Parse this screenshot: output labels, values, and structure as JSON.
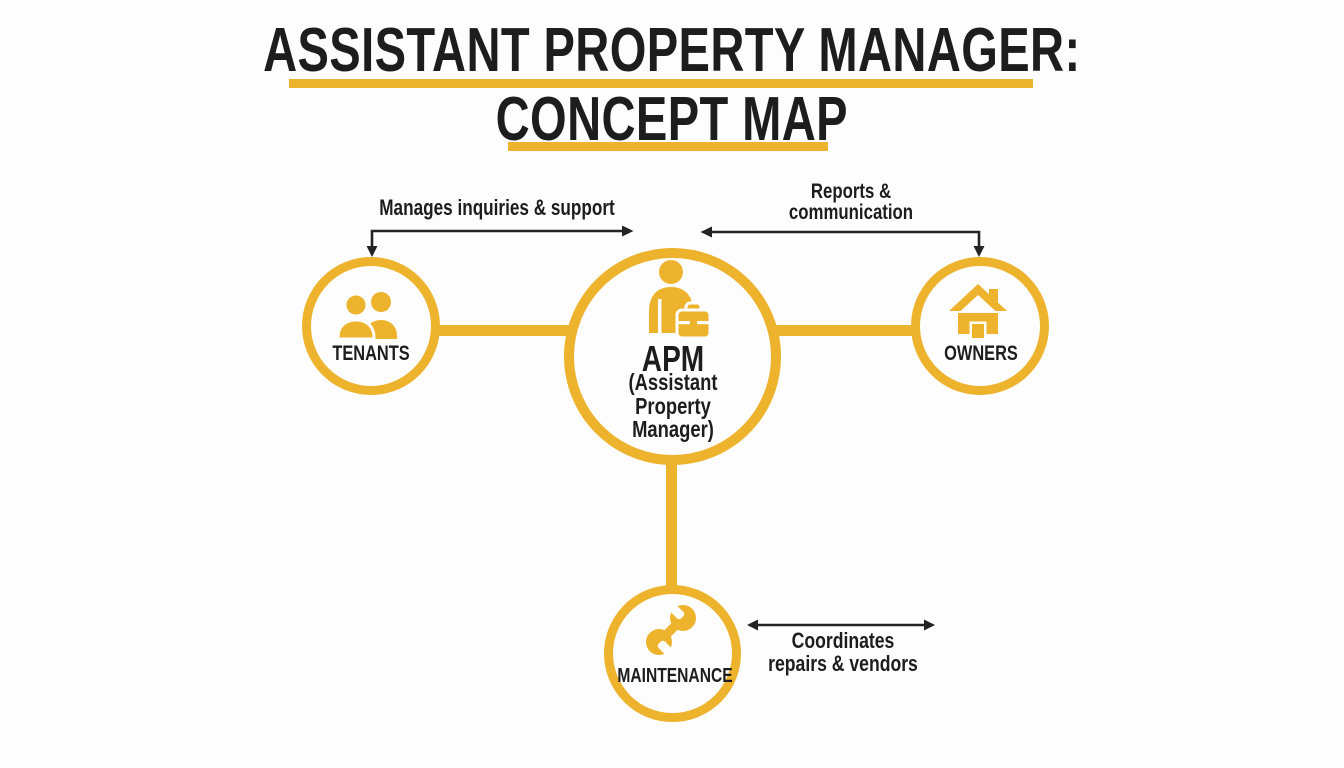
{
  "title": {
    "line1": "ASSISTANT PROPERTY MANAGER:",
    "line2": "CONCEPT MAP"
  },
  "center_node": {
    "label": "APM",
    "sublabel_lines": [
      "(Assistant",
      "Property",
      "Manager)"
    ],
    "icon": "person-briefcase-icon"
  },
  "nodes": [
    {
      "id": "tenants",
      "label": "TENANTS",
      "icon": "two-people-icon"
    },
    {
      "id": "owners",
      "label": "OWNERS",
      "icon": "house-icon"
    },
    {
      "id": "maintenance",
      "label": "MAINTENANCE",
      "icon": "wrench-icon"
    }
  ],
  "edge_labels": {
    "tenants": {
      "lines": [
        "Manages inquiries & support"
      ]
    },
    "owners": {
      "lines": [
        "Reports &",
        "communication"
      ]
    },
    "maintenance": {
      "lines": [
        "Coordinates",
        "repairs & vendors"
      ]
    }
  },
  "colors": {
    "accent_gold": "#EDB32D",
    "text_black": "#1D1D1D",
    "arrow_black": "#232323",
    "background": "#FDFDFD"
  }
}
